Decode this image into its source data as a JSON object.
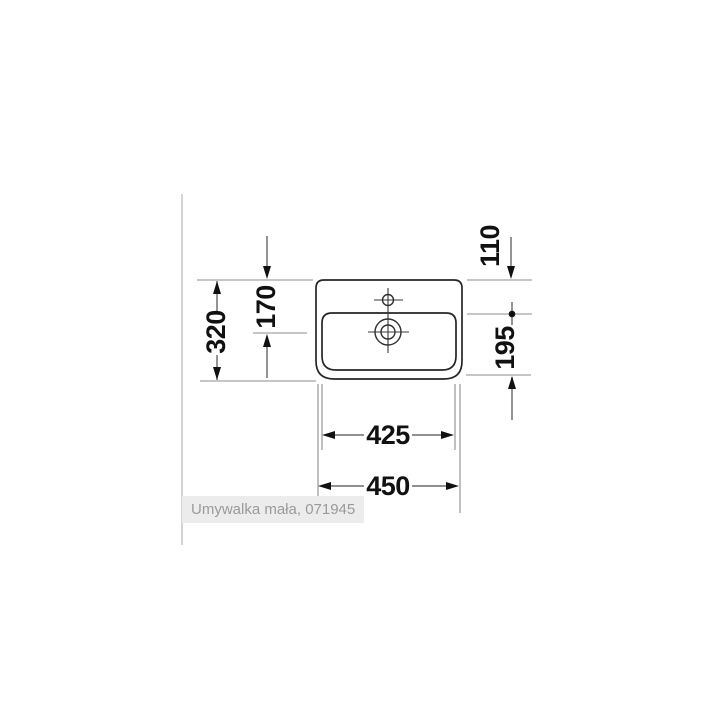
{
  "caption": "Umywalka mała, 071945",
  "drawing": {
    "dims": {
      "d110": "110",
      "d170": "170",
      "d320": "320",
      "d195": "195",
      "d425": "425",
      "d450": "450"
    }
  },
  "colors": {
    "outline": "#262626",
    "extension_line": "#8c8c8c",
    "dimension_line": "#4d4d4d",
    "arrow_and_text": "#111111",
    "caption_bg": "#ececec",
    "caption_text": "#9a9a9a",
    "divider": "#d4d4d4"
  }
}
